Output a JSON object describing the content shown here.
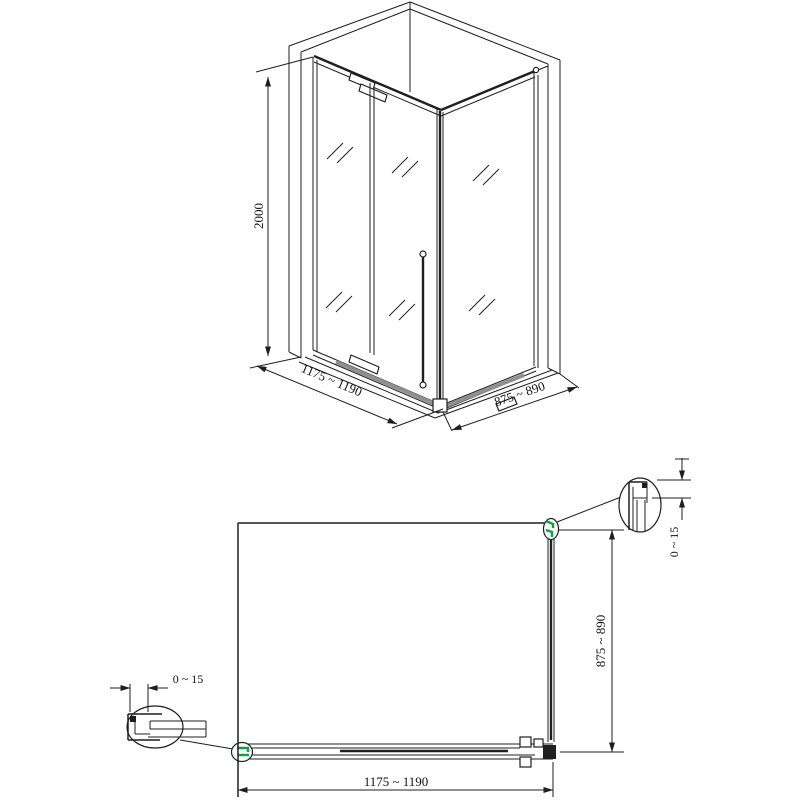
{
  "colors": {
    "line": "#1f1f1f",
    "highlight_green": "#0aa147",
    "track_gray": "#8f8f8f",
    "background": "#ffffff"
  },
  "iso": {
    "height_dim": "2000",
    "width_dim": "1175 ~ 1190",
    "depth_dim": "875 ~ 890"
  },
  "plan": {
    "width_dim": "1175 ~ 1190",
    "depth_dim": "875 ~ 890",
    "left_gap_dim": "0 ~ 15",
    "right_gap_dim": "0 ~ 15"
  }
}
